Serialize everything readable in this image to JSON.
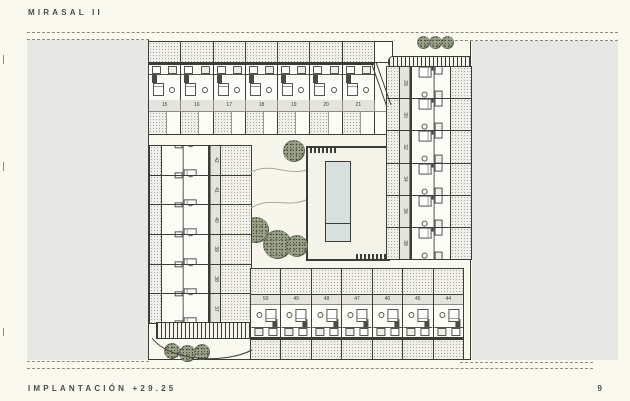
{
  "page": {
    "title": "MIRASAL II",
    "footer_label": "IMPLANTACIÓN +29.25",
    "page_number": "9"
  },
  "colors": {
    "background": "#FAF9F0",
    "road": "#E7E7E3",
    "line": "#3D3D38",
    "stipple_base": "#F0EFE9",
    "label_strip": "#E4E3DD",
    "pool_water": "#D8E0DF",
    "tree": "#9AA189",
    "text": "#4C4C46"
  },
  "plan": {
    "top_row": {
      "units": [
        "15",
        "16",
        "17",
        "18",
        "19",
        "20",
        "21"
      ]
    },
    "right_column": {
      "units": [
        "28",
        "30",
        "32",
        "34",
        "36",
        "38"
      ]
    },
    "left_column": {
      "units": [
        "42",
        "41",
        "40",
        "39",
        "38",
        "37"
      ]
    },
    "bottom_row": {
      "units": [
        "50",
        "49",
        "48",
        "47",
        "46",
        "45",
        "44"
      ]
    },
    "landscape": {
      "courtyard_trees": 4,
      "top_right_trees": 3,
      "bottom_left_trees": 3
    }
  }
}
